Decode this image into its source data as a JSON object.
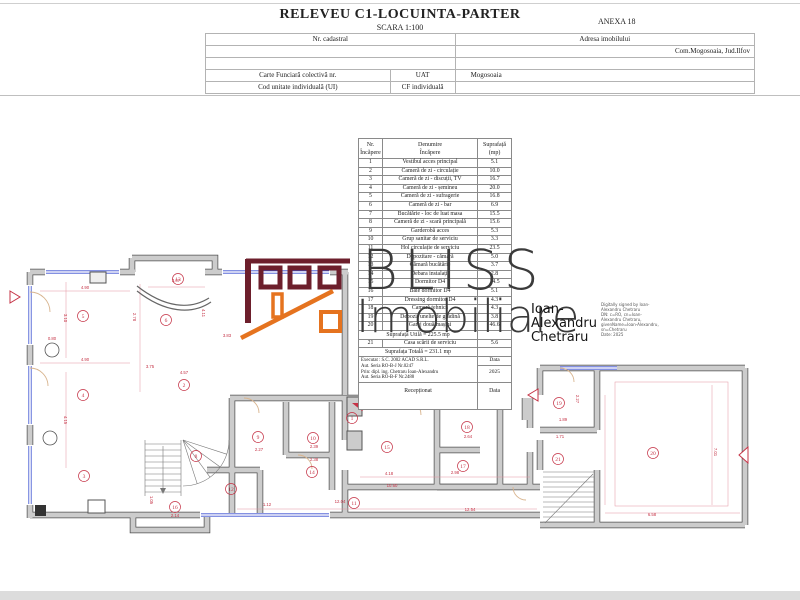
{
  "header": {
    "title": "RELEVEU C1-LOCUINTA-PARTER",
    "scale": "SCARA 1:100",
    "annex": "ANEXA 18",
    "info": {
      "nr_cadastral": "Nr. cadastral",
      "adresa_label": "Adresa imobilului",
      "adresa_value": "Com.Mogosoaia, Jud.Ilfov",
      "carte_funciara": "Carte Funciară colectivă nr.",
      "uat_label": "UAT",
      "uat_value": "Mogosoaia",
      "cod_unitate": "Cod unitate individuală (UI)",
      "cf_individuala": "CF individuală"
    }
  },
  "room_table": {
    "headers": {
      "c1l1": "Nr.",
      "c1l2": "Încăpere",
      "c2l1": "Denumire",
      "c2l2": "Încăpere",
      "c3l1": "Suprafață",
      "c3l2": "(mp)"
    },
    "rows": [
      {
        "nr": "1",
        "name": "Vestibul acces principal",
        "mp": "5.1"
      },
      {
        "nr": "2",
        "name": "Cameră de zi - circulație",
        "mp": "10.0"
      },
      {
        "nr": "3",
        "name": "Cameră de zi - discuții, TV",
        "mp": "16.7"
      },
      {
        "nr": "4",
        "name": "Cameră de zi - șemineu",
        "mp": "20.0"
      },
      {
        "nr": "5",
        "name": "Cameră de zi - sufragerie",
        "mp": "16.8"
      },
      {
        "nr": "6",
        "name": "Cameră de zi - bar",
        "mp": "6.9"
      },
      {
        "nr": "7",
        "name": "Bucătărie - loc de luat masa",
        "mp": "15.5"
      },
      {
        "nr": "8",
        "name": "Cameră de zi - scară principală",
        "mp": "15.6"
      },
      {
        "nr": "9",
        "name": "Garderobă acces",
        "mp": "5.3"
      },
      {
        "nr": "10",
        "name": "Grup sanitar de serviciu",
        "mp": "3.3"
      },
      {
        "nr": "11",
        "name": "Hol circulație de serviciu",
        "mp": "23.5"
      },
      {
        "nr": "12",
        "name": "Depozitare - cămară",
        "mp": "5.0"
      },
      {
        "nr": "13",
        "name": "Cămară bucătărie",
        "mp": "3.7"
      },
      {
        "nr": "14",
        "name": "Debara instalații",
        "mp": "2.8"
      },
      {
        "nr": "15",
        "name": "Dormitor D4",
        "mp": "14.5"
      },
      {
        "nr": "16",
        "name": "Baie dormitor D4",
        "mp": "5.1"
      },
      {
        "nr": "17",
        "name": "Dressing dormitor D4",
        "mp": "4.3"
      },
      {
        "nr": "18",
        "name": "Cameră tehnică",
        "mp": "4.3"
      },
      {
        "nr": "19",
        "name": "Depozit unelte de grădină",
        "mp": "3.8"
      },
      {
        "nr": "20",
        "name": "Garaj două mașini",
        "mp": "46.6"
      },
      {
        "nr": "21",
        "name": "Casa scării de serviciu",
        "mp": "5.6"
      }
    ],
    "suprafata_utila": "Suprafața Utilă = 225.5 mp",
    "suprafata_totala": "Suprafața Totală = 231.1 mp",
    "executat_lines": [
      "Executat : S.C. 2002 ACAD S.R.L.",
      "Aut. Seria RO-B-J Nr.0247",
      "Prin: dipl. ing. Chetraru Ioan-Alexandru",
      "Aut. Seria RO-B-F Nr.2488"
    ],
    "data_label": "Data",
    "data_value": "2025",
    "receptionat_label": "Recepționat"
  },
  "watermark": {
    "brand_line1": "BLISS",
    "brand_line2": "Imobiliare",
    "colors": {
      "maroon": "#6d1f2c",
      "orange": "#e5731f",
      "text": "#3b3b3b"
    }
  },
  "signature": {
    "name_lines": [
      "Ioan-",
      "Alexandru",
      "Chetraru"
    ],
    "cert_lines": [
      "Digitally signed by Ioan-",
      "Alexandru Chetraru",
      "DN: c=RO, cn=Ioan-",
      "Alexandru Chetraru,",
      "givenName=Ioan-Alexandru,",
      "sn=Chetraru",
      "Date: 2025"
    ]
  },
  "plan": {
    "accent_red": "#c53346",
    "rooms": [
      {
        "n": "1",
        "x": 352,
        "y": 418
      },
      {
        "n": "2",
        "x": 184,
        "y": 385
      },
      {
        "n": "3",
        "x": 84,
        "y": 476
      },
      {
        "n": "4",
        "x": 83,
        "y": 395
      },
      {
        "n": "5",
        "x": 83,
        "y": 316
      },
      {
        "n": "6",
        "x": 166,
        "y": 320
      },
      {
        "n": "7",
        "x": 468,
        "y": 388
      },
      {
        "n": "8",
        "x": 196,
        "y": 456
      },
      {
        "n": "9",
        "x": 258,
        "y": 437
      },
      {
        "n": "10",
        "x": 313,
        "y": 438
      },
      {
        "n": "11",
        "x": 354,
        "y": 503
      },
      {
        "n": "12",
        "x": 231,
        "y": 489
      },
      {
        "n": "13",
        "x": 178,
        "y": 279
      },
      {
        "n": "14",
        "x": 312,
        "y": 472
      },
      {
        "n": "15",
        "x": 387,
        "y": 447
      },
      {
        "n": "16",
        "x": 175,
        "y": 507
      },
      {
        "n": "17",
        "x": 463,
        "y": 466
      },
      {
        "n": "18",
        "x": 467,
        "y": 427
      },
      {
        "n": "19",
        "x": 559,
        "y": 403
      },
      {
        "n": "20",
        "x": 653,
        "y": 453
      },
      {
        "n": "21",
        "x": 558,
        "y": 459
      }
    ],
    "dims": [
      {
        "t": "4.90",
        "x": 85,
        "y": 289,
        "r": 0
      },
      {
        "t": "3.10",
        "x": 64,
        "y": 318,
        "r": 90
      },
      {
        "t": "0.80",
        "x": 52,
        "y": 340,
        "r": 0
      },
      {
        "t": "4.90",
        "x": 85,
        "y": 361,
        "r": 0
      },
      {
        "t": "4.15",
        "x": 64,
        "y": 420,
        "r": 90
      },
      {
        "t": "3.07",
        "x": 176,
        "y": 282,
        "r": 0
      },
      {
        "t": "2.78",
        "x": 133,
        "y": 317,
        "r": 90
      },
      {
        "t": "4.11",
        "x": 202,
        "y": 313,
        "r": 90
      },
      {
        "t": "3.83",
        "x": 227,
        "y": 337,
        "r": 0
      },
      {
        "t": "4.57",
        "x": 184,
        "y": 374,
        "r": 0
      },
      {
        "t": "3.75",
        "x": 150,
        "y": 368,
        "r": 0
      },
      {
        "t": "2.27",
        "x": 259,
        "y": 451,
        "r": 0
      },
      {
        "t": "2.39",
        "x": 314,
        "y": 448,
        "r": 0
      },
      {
        "t": "2.38",
        "x": 314,
        "y": 461,
        "r": 0
      },
      {
        "t": "4.18",
        "x": 389,
        "y": 475,
        "r": 0
      },
      {
        "t": "10.60",
        "x": 392,
        "y": 487,
        "r": 0
      },
      {
        "t": "12.04",
        "x": 340,
        "y": 503,
        "r": 0
      },
      {
        "t": "12.54",
        "x": 470,
        "y": 511,
        "r": 0
      },
      {
        "t": "1.12",
        "x": 267,
        "y": 506,
        "r": 0
      },
      {
        "t": "2.64",
        "x": 468,
        "y": 438,
        "r": 0
      },
      {
        "t": "2.98",
        "x": 455,
        "y": 474,
        "r": 0
      },
      {
        "t": "1.89",
        "x": 563,
        "y": 421,
        "r": 0
      },
      {
        "t": "1.71",
        "x": 560,
        "y": 438,
        "r": 0
      },
      {
        "t": "2.27",
        "x": 576,
        "y": 399,
        "r": 90
      },
      {
        "t": "7.01",
        "x": 714,
        "y": 452,
        "r": 90
      },
      {
        "t": "6.58",
        "x": 652,
        "y": 516,
        "r": 0
      },
      {
        "t": "2.14",
        "x": 175,
        "y": 517,
        "r": 0
      },
      {
        "t": "1.05",
        "x": 150,
        "y": 500,
        "r": 90
      }
    ]
  }
}
